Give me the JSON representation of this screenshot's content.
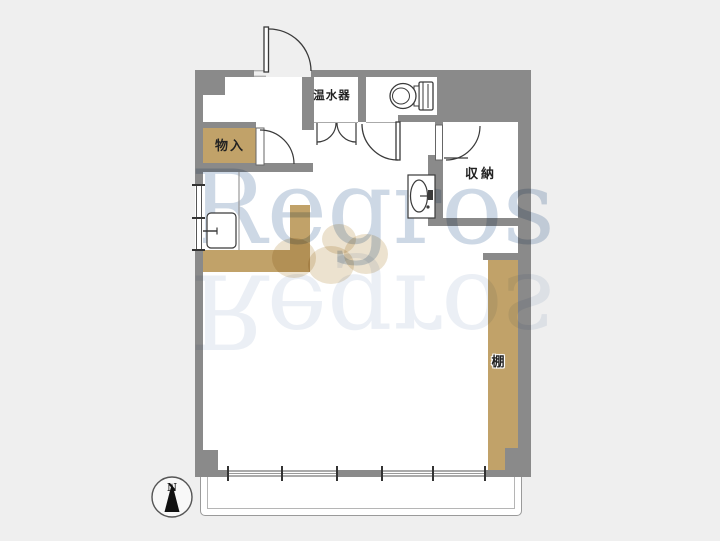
{
  "plan": {
    "type": "apartment-floorplan",
    "labels": {
      "storage_closet": "物入",
      "water_heater": "温水器",
      "closet": "収納",
      "shelf": "棚"
    },
    "fixtures": [
      "toilet",
      "washbasin",
      "kitchen-sink",
      "kitchen-counter"
    ],
    "doors": [
      "entrance-door",
      "water-heater-double-doors",
      "toilet-door",
      "closet-door",
      "storage-door"
    ],
    "windows": [
      "kitchen-left-window",
      "balcony-window-left",
      "balcony-window-right"
    ]
  },
  "watermark": {
    "text": "Regros"
  },
  "compass": {
    "north_label": "N"
  },
  "colors": {
    "wall": "#8a8a8a",
    "fixture_tan": "#c1a269",
    "interior": "#ffffff",
    "background": "#efefef",
    "line": "#3a3a3a",
    "watermark_blue": "#a8bbd3"
  }
}
